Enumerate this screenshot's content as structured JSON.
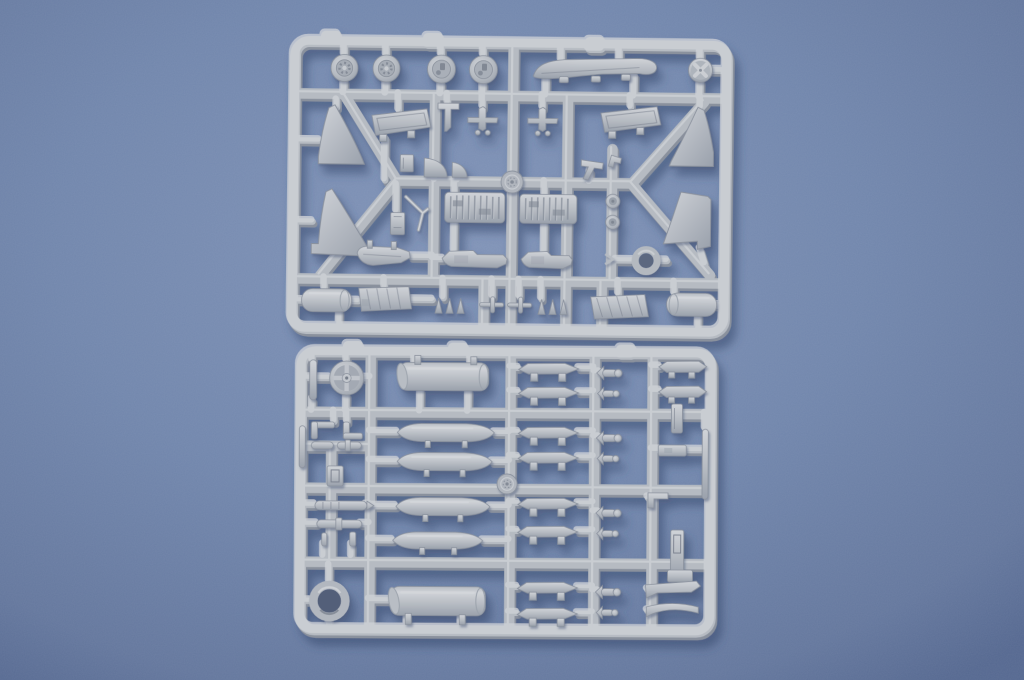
{
  "scene": {
    "type": "photograph",
    "description": "Top-down studio photo of two light-grey injection-moulded plastic model kit sprues (runner frames holding aircraft parts) lying on a blue textured paper background",
    "text_visible": "none",
    "lighting": "soft light from upper left, sprues cast soft shadows down-right"
  },
  "colors": {
    "bg-light": "#8093b7",
    "bg-mid": "#7186ac",
    "bg-dark": "#64779d",
    "bg-corner": "#556890",
    "plastic": "#b6bbc2",
    "plastic-hi": "#d0d3d8",
    "plastic-lo": "#9aa1ac",
    "plastic-edge": "#8a919d",
    "plastic-line": "#7b8290",
    "recess": "#6f7684",
    "hole": "#566279",
    "shadow": "#36486c"
  },
  "sprues": [
    {
      "id": "sprue-top",
      "description": "Airframe sprue: four road wheels, dorsal spine strip, cross-hub disc, four triangular fin halves, two intake ramp panels, two ribbed wheel-bay inserts, two missile launch rails, landing gear parts, nozzle ring, two fuel tank end cylinders, small bombs and struts, central gate boss",
      "parts": [
        "road-wheel x2",
        "main-wheel x2",
        "dorsal-spine",
        "cross-hub-disc",
        "fin-half x4",
        "intake-ramp x2",
        "wheel-bay-insert x2",
        "missile-rail x2",
        "gear-sled",
        "gear-leg",
        "quarter-disc x2",
        "small-wheel x2",
        "nozzle-ring",
        "tank-end-cylinder x2",
        "ribbed-fairing x2",
        "small-bombs-and-struts",
        "gate-boss"
      ]
    },
    {
      "id": "sprue-bottom",
      "description": "Stores sprue: spoked hub wheel, two large tank cylinders, four pointed drop-tank halves, ten stores pylons, four bomb-with-fins sets, exhaust ring, strakes, brackets and rods, central gate boss",
      "parts": [
        "spoked-wheel",
        "tank-cylinder x2",
        "drop-tank-half x4",
        "pylon x10",
        "bomb-fin-set x4",
        "exhaust-ring",
        "strake x2",
        "bracket x3",
        "rod x5",
        "gate-boss"
      ]
    }
  ]
}
